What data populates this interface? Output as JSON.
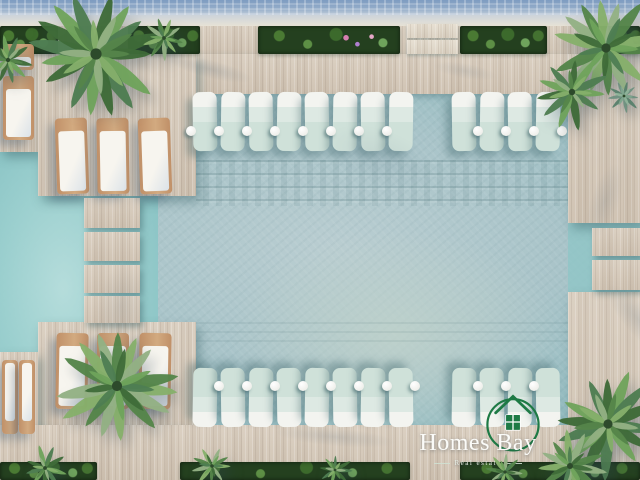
{
  "image": {
    "title": "Aerial 3D render of resort swimming pool with deck, sun loungers and palm trees",
    "watermark": "Homes Bay"
  },
  "logo": {
    "title": "Homes Bay",
    "subtitle": "Real estate",
    "icon": "house-in-circle-icon",
    "green": "#1e7a45",
    "text_color": "#fbfbf8"
  },
  "palette": {
    "deck": "#d7cbbb",
    "deck_light": "#e4dccd",
    "wood": "#c09068",
    "greenery": "#24401f",
    "palm_dark": "#3f6b39",
    "palm_light": "#86b06b"
  },
  "scene": {
    "planters_top": [
      {
        "x": 0,
        "w": 58
      },
      {
        "x": 128,
        "w": 72
      },
      {
        "x": 258,
        "w": 142,
        "flowers": true
      },
      {
        "x": 460,
        "w": 87
      },
      {
        "x": 596,
        "w": 44
      }
    ],
    "steps_top": {
      "x": 407,
      "w": 51,
      "slats": [
        {
          "y": 24,
          "h": 14
        },
        {
          "y": 40,
          "h": 14
        }
      ]
    },
    "walkway": [
      {
        "y": 198,
        "h": 30
      },
      {
        "y": 232,
        "h": 29
      },
      {
        "y": 265,
        "h": 28
      },
      {
        "y": 296,
        "h": 27
      }
    ],
    "walkway_x": 84,
    "walkway_w": 56,
    "right_steps": [
      {
        "y": 228,
        "h": 28
      },
      {
        "y": 260,
        "h": 30
      }
    ],
    "right_steps_x": 592,
    "right_steps_w": 48,
    "pool_loungers_top": [
      193,
      221,
      249,
      277,
      305,
      333,
      361,
      389,
      452,
      480,
      508,
      536
    ],
    "pool_loungers_bottom": [
      193,
      221,
      249,
      277,
      305,
      333,
      361,
      389,
      452,
      480,
      508,
      536
    ],
    "balls_top": [
      191,
      219,
      247,
      275,
      303,
      331,
      359,
      387,
      478,
      506,
      534,
      562
    ],
    "balls_bottom": [
      219,
      247,
      275,
      303,
      331,
      359,
      387,
      415,
      478,
      506,
      534
    ],
    "deck_loungers": [
      {
        "x": 3,
        "y": 44,
        "w": 31,
        "h": 26,
        "head": "top",
        "rot": 0
      },
      {
        "x": 3,
        "y": 76,
        "w": 31,
        "h": 64,
        "head": "top",
        "rot": 0
      },
      {
        "x": 56,
        "y": 118,
        "w": 32,
        "h": 76,
        "head": "top",
        "rot": -2
      },
      {
        "x": 97,
        "y": 118,
        "w": 32,
        "h": 76,
        "head": "top",
        "rot": -1
      },
      {
        "x": 139,
        "y": 118,
        "w": 32,
        "h": 76,
        "head": "top",
        "rot": -2
      },
      {
        "x": 56,
        "y": 333,
        "w": 32,
        "h": 76,
        "head": "top",
        "rot": 1
      },
      {
        "x": 97,
        "y": 333,
        "w": 32,
        "h": 76,
        "head": "top",
        "rot": 0
      },
      {
        "x": 139,
        "y": 333,
        "w": 32,
        "h": 76,
        "head": "top",
        "rot": 1
      },
      {
        "x": 2,
        "y": 360,
        "w": 16,
        "h": 74,
        "head": "bottom",
        "rot": 0
      },
      {
        "x": 19,
        "y": 360,
        "w": 16,
        "h": 74,
        "head": "bottom",
        "rot": 0
      }
    ],
    "palms": [
      {
        "x": 96,
        "y": 54,
        "r": 70,
        "n": 16
      },
      {
        "x": 606,
        "y": 48,
        "r": 58,
        "n": 14
      },
      {
        "x": 572,
        "y": 92,
        "r": 40,
        "n": 11
      },
      {
        "x": 117,
        "y": 386,
        "r": 64,
        "n": 15
      },
      {
        "x": 608,
        "y": 424,
        "r": 58,
        "n": 14
      },
      {
        "x": 570,
        "y": 466,
        "r": 38,
        "n": 11
      },
      {
        "x": 8,
        "y": 60,
        "r": 28,
        "n": 10
      },
      {
        "x": 164,
        "y": 38,
        "r": 24,
        "n": 9
      },
      {
        "x": 45,
        "y": 468,
        "r": 24,
        "n": 9
      },
      {
        "x": 212,
        "y": 466,
        "r": 22,
        "n": 9
      },
      {
        "x": 335,
        "y": 470,
        "r": 18,
        "n": 8
      },
      {
        "x": 505,
        "y": 472,
        "r": 20,
        "n": 8
      },
      {
        "x": 624,
        "y": 96,
        "r": 18,
        "n": 9,
        "agave": true
      }
    ],
    "greenery_bottom": [
      {
        "x": 0,
        "w": 97
      },
      {
        "x": 180,
        "w": 230
      },
      {
        "x": 460,
        "w": 180
      }
    ],
    "shadows": [
      {
        "x": 150,
        "y": 56,
        "w": 120,
        "h": 26,
        "rot": 14,
        "o": 0.3
      },
      {
        "x": 585,
        "y": 146,
        "w": 40,
        "h": 110,
        "rot": 18,
        "o": 0.22
      },
      {
        "x": 575,
        "y": 300,
        "w": 130,
        "h": 42,
        "rot": 48,
        "o": 0.28
      },
      {
        "x": 250,
        "y": 424,
        "w": 170,
        "h": 26,
        "rot": 5,
        "o": 0.25
      },
      {
        "x": 300,
        "y": 118,
        "w": 160,
        "h": 80,
        "rot": 20,
        "o": 0.16
      },
      {
        "x": 88,
        "y": 246,
        "w": 66,
        "h": 120,
        "rot": 8,
        "o": 0.18
      },
      {
        "x": 420,
        "y": 60,
        "w": 90,
        "h": 22,
        "rot": 10,
        "o": 0.2
      }
    ]
  }
}
